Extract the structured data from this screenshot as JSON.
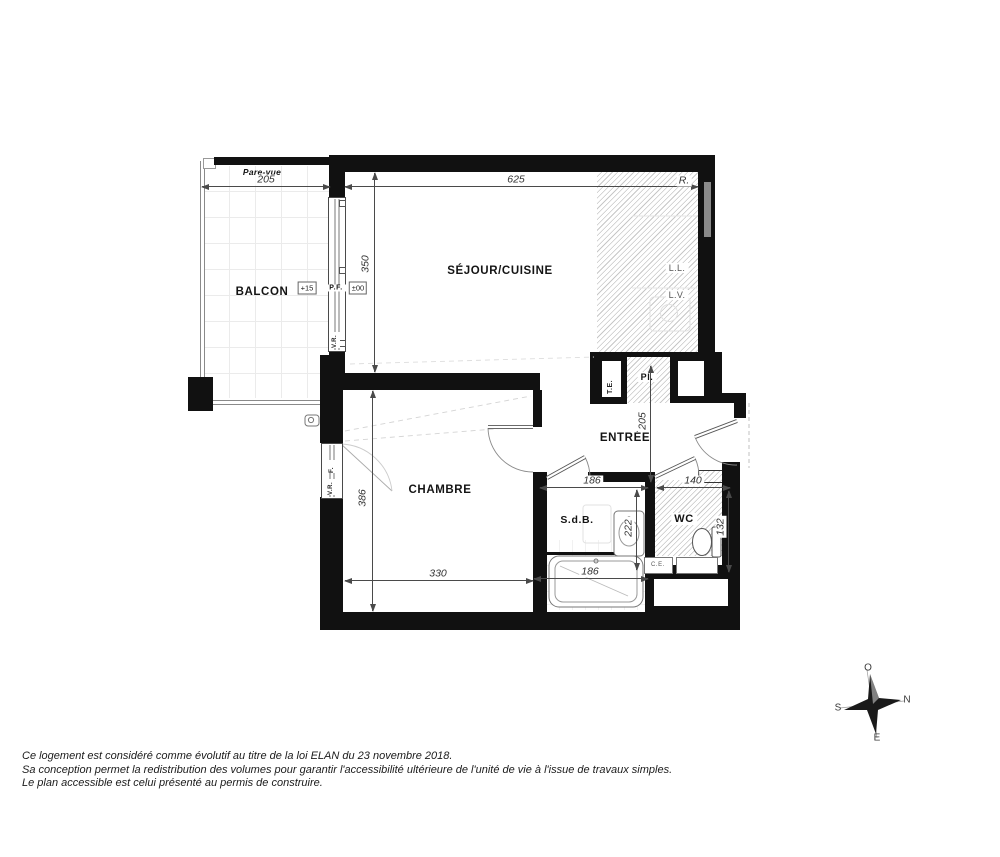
{
  "rooms": {
    "balcon": "BALCON",
    "sejour": "SÉJOUR/CUISINE",
    "chambre": "CHAMBRE",
    "entree": "ENTRÉE",
    "sdb": "S.d.B.",
    "wc": "WC",
    "placard": "Pl.",
    "tableau_electrique": "T.E."
  },
  "equipment": {
    "lave_linge": "L.L.",
    "lave_vaisselle": "L.V.",
    "refrigerateur": "R.",
    "chauffe_eau": "C.E."
  },
  "openings": {
    "porte_fenetre": "P.F.",
    "fenetre": "F.",
    "volet_roulant_sejour": "V.R.",
    "volet_roulant_chambre": "V.R.",
    "pare_vue": "Pare-vue"
  },
  "levels": {
    "balcon": "+15",
    "interieur": "±00"
  },
  "dimensions": {
    "balcon_largeur": "205",
    "sejour_largeur": "625",
    "sejour_profondeur": "350",
    "chambre_profondeur": "386",
    "chambre_largeur": "330",
    "entree_longueur": "205",
    "sdb_largeur": "186",
    "wc_largeur": "140",
    "sdb_profondeur": "222",
    "wc_profondeur": "132",
    "baignoire_largeur": "186"
  },
  "compass": {
    "nord": "N",
    "sud": "S",
    "est": "E",
    "ouest": "O"
  },
  "footer": {
    "line1": "Ce logement est considéré comme évolutif au titre de la loi ELAN du 23 novembre 2018.",
    "line2": "Sa conception permet la redistribution des volumes pour garantir l'accessibilité ultérieure de l'unité de vie à l'issue de travaux simples.",
    "line3": "Le plan accessible est celui présenté au permis de construire."
  }
}
